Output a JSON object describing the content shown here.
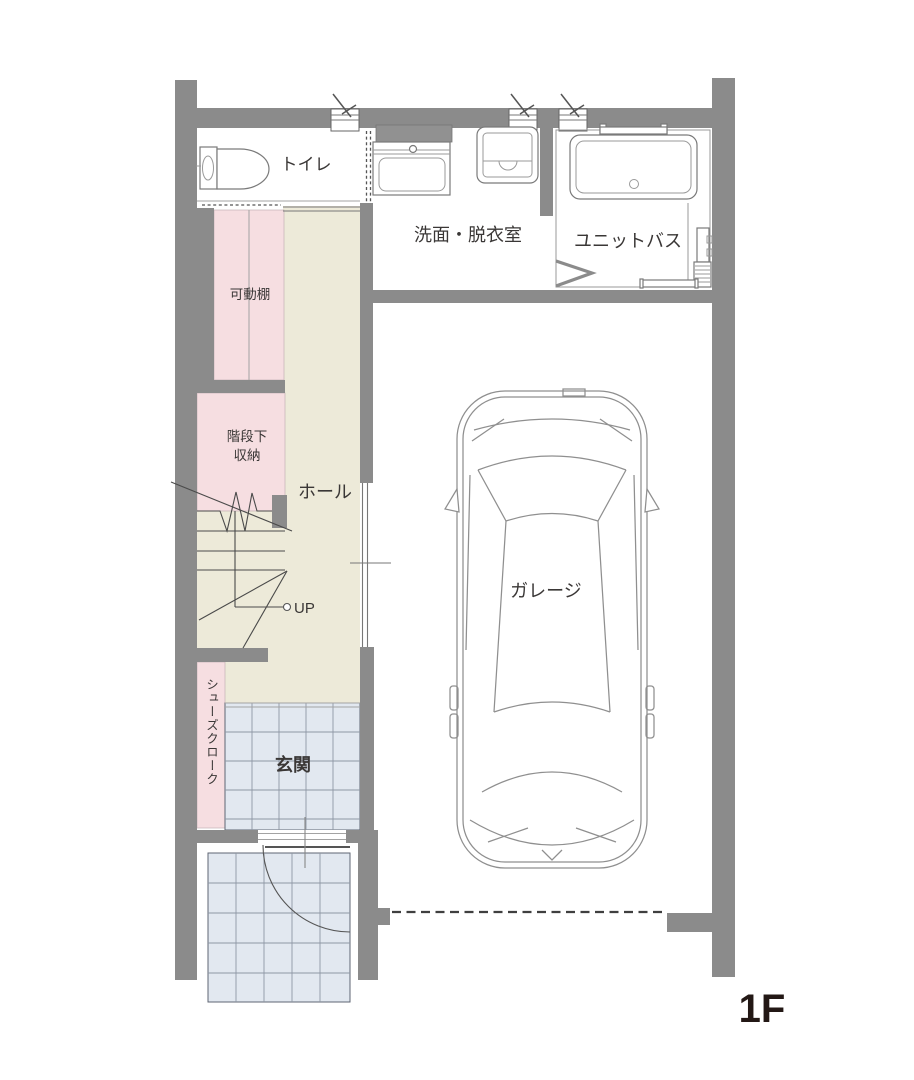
{
  "floor_label": "1F",
  "rooms": {
    "toilet": {
      "label": "トイレ"
    },
    "washroom": {
      "label": "洗面・脱衣室"
    },
    "unit_bath": {
      "label": "ユニットバス"
    },
    "movable_shelf": {
      "label": "可動棚"
    },
    "under_stairs_storage": {
      "label_line1": "階段下",
      "label_line2": "収納"
    },
    "hall": {
      "label": "ホール"
    },
    "stairs": {
      "up_label": "UP"
    },
    "shoe_closet": {
      "label": "シューズクローク"
    },
    "entrance": {
      "label": "玄関"
    },
    "garage": {
      "label": "ガレージ"
    }
  },
  "colors": {
    "wall": "#8b8b8b",
    "hall_floor": "#edead9",
    "storage_floor_pink": "#f6dee1",
    "tile_floor": "#e2e8f0",
    "fixture_line": "#7a7a7a",
    "label_text": "#3a3736",
    "floor_label_text": "#231815"
  }
}
